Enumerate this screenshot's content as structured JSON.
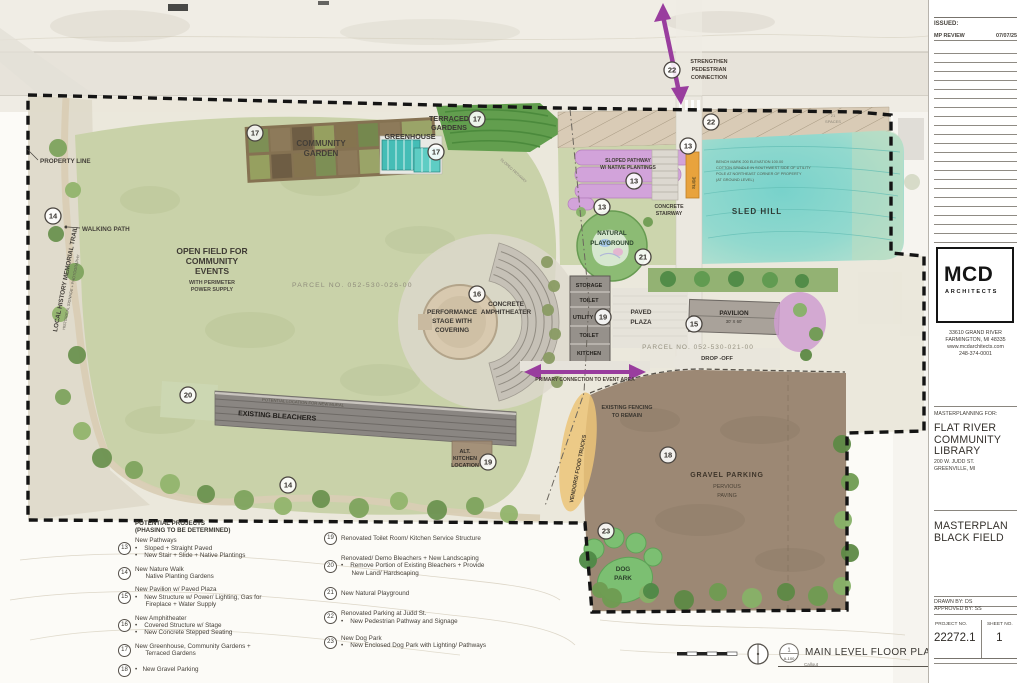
{
  "plan": {
    "street": "W JUDD STREET",
    "colors": {
      "arrow_purple": "#993d9e",
      "sled_hill_teal": "#7ed2cc",
      "field_green": "#c9d2a9",
      "gravel_brown": "#9c8874",
      "pathway_pink": "#d2a3da",
      "slide_orange": "#e8a33d",
      "dog_park_green": "#7cbf72"
    },
    "labels": {
      "property_line": "PROPERTY LINE",
      "walking_path": "WALKING PATH",
      "memorial_trail": "LOCAL HISTORY MEMORIAL TRAIL",
      "memorial_trail_sub": "HISTORICAL SIGNAGE + PHOTOGRAPHY",
      "open_field": [
        "OPEN FIELD FOR",
        "COMMUNITY",
        "EVENTS"
      ],
      "open_field_sub": [
        "WITH PERIMETER",
        "POWER SUPPLY"
      ],
      "parcel_026": "PARCEL NO. 052-530-026-00",
      "parcel_021": "PARCEL NO. 052-530-021-00",
      "community_garden": [
        "COMMUNITY",
        "GARDEN"
      ],
      "greenhouse": "GREENHOUSE",
      "terraced_gardens": [
        "TERRACED",
        "GARDENS"
      ],
      "sloped_pathway": [
        "SLOPED PATHWAY",
        "W/ NATIVE PLANTINGS"
      ],
      "sloped_pathway_faint": "SLOPED PATHWAY",
      "slide": "SLIDE",
      "concrete_stairway": [
        "CONCRETE",
        "STAIRWAY"
      ],
      "sled_hill": "SLED HILL",
      "benchmark": [
        "BENCH MARK 200    ELEVATION  100.00",
        "COTTON SPINDLE IN SOUTHWEST SIDE OF UTILITY",
        "POLE AT NORTHEAST CORNER OF PROPERTY",
        "(AT GROUND LEVEL)"
      ],
      "natural_playground": [
        "NATURAL",
        "PLAYGROUND"
      ],
      "performance_stage": [
        "PERFORMANCE",
        "STAGE WITH",
        "COVERING"
      ],
      "concrete_amphitheater": [
        "CONCRETE",
        "AMPHITHEATER"
      ],
      "rooms": [
        "STORAGE",
        "TOILET",
        "UTILITY",
        "TOILET",
        "KITCHEN"
      ],
      "paved_plaza": [
        "PAVED",
        "PLAZA"
      ],
      "pavilion": "PAVILION",
      "pavilion_size": "30' X 60'",
      "drop_off": "DROP -OFF",
      "strengthen": [
        "STRENGTHEN",
        "PEDESTRIAN",
        "CONNECTION"
      ],
      "primary_connection": "PRIMARY CONNECTION TO EVENT AREA",
      "existing_bleachers": "EXISTING BLEACHERS",
      "mural": "POTENTIAL LOCATION FOR NEW MURAL",
      "alt_kitchen": [
        "ALT.",
        "KITCHEN",
        "LOCATION"
      ],
      "vendors": "VENDORS/ FOOD TRUCKS",
      "existing_fencing": [
        "EXISTING FENCING",
        "TO REMAIN"
      ],
      "gravel_parking": "GRAVEL PARKING",
      "pervious": [
        "PERVIOUS",
        "PAVING"
      ],
      "dog_park": [
        "DOG",
        "PARK"
      ],
      "spaces_21": [
        "21",
        "SPACES"
      ]
    },
    "nums": {
      "13": "13",
      "14": "14",
      "15": "15",
      "16": "16",
      "17": "17",
      "18": "18",
      "19": "19",
      "20": "20",
      "21": "21",
      "22": "22",
      "23": "23"
    }
  },
  "legend": {
    "header": [
      "POTENTIAL PROJECTS",
      "(PHASING TO BE DETERMINED)"
    ],
    "left": [
      {
        "num": "13",
        "lines": [
          "New Pathways",
          "•    Sloped + Straight Paved",
          "•    New Stair + Slide + Native Plantings"
        ]
      },
      {
        "num": "14",
        "lines": [
          "New Nature Walk",
          "      Native Planting Gardens"
        ]
      },
      {
        "num": "15",
        "lines": [
          "New Pavilion w/ Paved Plaza",
          "•    New Structure w/ Power/ Lighting, Gas for",
          "      Fireplace + Water Supply"
        ]
      },
      {
        "num": "16",
        "lines": [
          "New Amphitheater",
          "•    Covered Structure w/ Stage",
          "•    New Concrete Stepped Seating"
        ]
      },
      {
        "num": "17",
        "lines": [
          "New Greenhouse, Community Gardens +",
          "      Terraced Gardens"
        ]
      },
      {
        "num": "18",
        "lines": [
          "•   New Gravel Parking"
        ]
      }
    ],
    "right": [
      {
        "num": "19",
        "lines": [
          "Renovated Toilet Room/ Kitchen Service Structure"
        ]
      },
      {
        "num": "20",
        "lines": [
          "Renovated/ Demo Bleachers + New Landscaping",
          "•    Remove Portion of Existing Bleachers + Provide",
          "      New Land/ Hardscaping"
        ]
      },
      {
        "num": "21",
        "lines": [
          "New Natural Playground"
        ]
      },
      {
        "num": "22",
        "lines": [
          "Renovated Parking at Judd St.",
          "•    New Pedestrian Pathway and Signage"
        ]
      },
      {
        "num": "23",
        "lines": [
          "New Dog Park",
          "•    New Enclosed Dog Park with Lighting/ Pathways"
        ]
      }
    ]
  },
  "footer": {
    "view_no": "1",
    "view_ref": "A-100",
    "title": "MAIN LEVEL FLOOR PLAN",
    "note": "Callout"
  },
  "titleblock": {
    "issued_label": "ISSUED:",
    "revision": {
      "name": "MP REVIEW",
      "date": "07/07/25"
    },
    "logo": {
      "name": "MCD",
      "sub": "ARCHITECTS"
    },
    "address": [
      "33610 GRAND RIVER",
      "FARMINGTON, MI 48335",
      "www.mcdarchitects.com",
      "248-374-0001"
    ],
    "for_label": "MASTERPLANNING FOR:",
    "client": [
      "FLAT RIVER",
      "COMMUNITY",
      "LIBRARY"
    ],
    "client_address": [
      "200 W. JUDD ST.",
      "GREENVILLE, MI"
    ],
    "sheet_title": [
      "MASTERPLAN",
      "BLACK FIELD"
    ],
    "drawn_by": "DRAWN BY: DS",
    "approved_by": "APPROVED BY: SS",
    "project_no_label": "PROJECT NO.",
    "project_no": "22272.1",
    "sheet_no_label": "SHEET NO.",
    "sheet_no": "1"
  }
}
